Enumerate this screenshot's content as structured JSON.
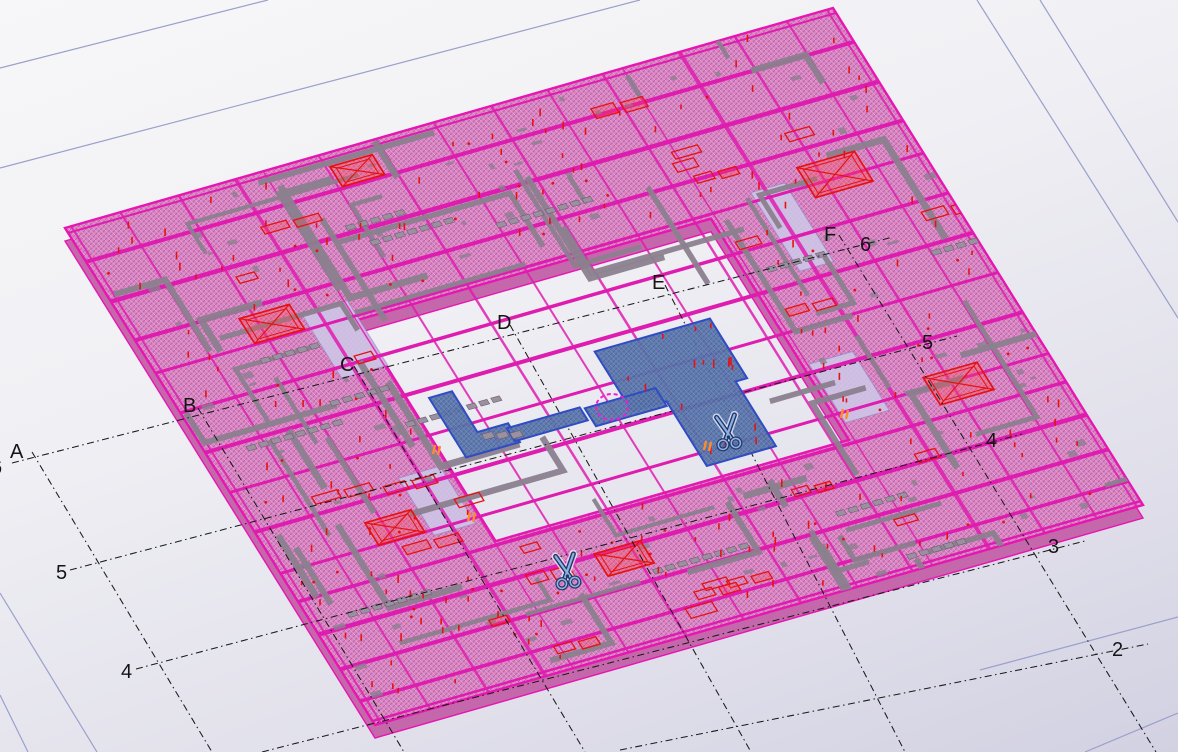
{
  "viewport": {
    "name": "cad-3d-model-view",
    "width": 1178,
    "height": 752
  },
  "grid": {
    "labels": [
      {
        "id": "A",
        "text": "A",
        "x": 10,
        "y": 458
      },
      {
        "id": "B",
        "text": "B",
        "x": 183,
        "y": 412
      },
      {
        "id": "C",
        "text": "C",
        "x": 340,
        "y": 371
      },
      {
        "id": "D",
        "text": "D",
        "x": 497,
        "y": 329
      },
      {
        "id": "E",
        "text": "E",
        "x": 652,
        "y": 289
      },
      {
        "id": "F",
        "text": "F",
        "x": 824,
        "y": 241
      },
      {
        "id": "6-left",
        "text": "6",
        "x": -9,
        "y": 474
      },
      {
        "id": "5-left",
        "text": "5",
        "x": 56,
        "y": 579
      },
      {
        "id": "4-left",
        "text": "4",
        "x": 121,
        "y": 678
      },
      {
        "id": "6-right",
        "text": "6",
        "x": 860,
        "y": 251
      },
      {
        "id": "5-right",
        "text": "5",
        "x": 922,
        "y": 349
      },
      {
        "id": "4-right",
        "text": "4",
        "x": 986,
        "y": 447
      },
      {
        "id": "3-right",
        "text": "3",
        "x": 1048,
        "y": 553
      },
      {
        "id": "2-right",
        "text": "2",
        "x": 1112,
        "y": 656
      }
    ],
    "lines": [
      {
        "id": "A",
        "x1": 32,
        "y1": 452,
        "x2": 212,
        "y2": 752
      },
      {
        "id": "B",
        "x1": 198,
        "y1": 408,
        "x2": 404,
        "y2": 752
      },
      {
        "id": "C",
        "x1": 354,
        "y1": 366,
        "x2": 585,
        "y2": 752
      },
      {
        "id": "D",
        "x1": 510,
        "y1": 325,
        "x2": 751,
        "y2": 752
      },
      {
        "id": "E",
        "x1": 665,
        "y1": 285,
        "x2": 905,
        "y2": 752
      },
      {
        "id": "F",
        "x1": 839,
        "y1": 235,
        "x2": 1156,
        "y2": 752
      },
      {
        "id": "6",
        "x1": 12,
        "y1": 463,
        "x2": 893,
        "y2": 237
      },
      {
        "id": "5",
        "x1": 70,
        "y1": 570,
        "x2": 957,
        "y2": 336
      },
      {
        "id": "4",
        "x1": 136,
        "y1": 669,
        "x2": 1022,
        "y2": 434
      },
      {
        "id": "3",
        "x1": 262,
        "y1": 752,
        "x2": 1085,
        "y2": 541
      },
      {
        "id": "2",
        "x1": 620,
        "y1": 750,
        "x2": 1148,
        "y2": 644
      }
    ]
  },
  "boundary_lines": [
    {
      "x1": 0,
      "y1": 68,
      "x2": 268,
      "y2": 0
    },
    {
      "x1": 0,
      "y1": 168,
      "x2": 640,
      "y2": 0
    },
    {
      "x1": 977,
      "y1": 0,
      "x2": 1178,
      "y2": 318
    },
    {
      "x1": 1040,
      "y1": 0,
      "x2": 1178,
      "y2": 222
    },
    {
      "x1": 0,
      "y1": 593,
      "x2": 97,
      "y2": 752
    },
    {
      "x1": 0,
      "y1": 695,
      "x2": 28,
      "y2": 752
    },
    {
      "x1": 980,
      "y1": 670,
      "x2": 1178,
      "y2": 617
    },
    {
      "x1": 1085,
      "y1": 752,
      "x2": 1178,
      "y2": 713
    }
  ],
  "scene": {
    "plan_transform": {
      "a": 0.768,
      "b": -0.22,
      "c": 0.31,
      "d": 0.497,
      "e": 65,
      "f": 228
    },
    "ring": {
      "outer": [
        [
          0,
          0
        ],
        [
          1000,
          0
        ],
        [
          1000,
          1000
        ],
        [
          0,
          1000
        ]
      ],
      "hole": [
        [
          260,
          300
        ],
        [
          720,
          300
        ],
        [
          720,
          745
        ],
        [
          260,
          745
        ]
      ],
      "thickness_px": 13
    },
    "panels": [
      {
        "x": 782,
        "y": 275,
        "w": 44,
        "h": 158
      },
      {
        "x": 728,
        "y": 596,
        "w": 57,
        "h": 118
      },
      {
        "x": 202,
        "y": 262,
        "w": 60,
        "h": 130
      },
      {
        "x": 196,
        "y": 590,
        "w": 54,
        "h": 115
      }
    ],
    "beams_x": [
      {
        "y": 10,
        "w": 2
      },
      {
        "y": 68,
        "w": 4
      },
      {
        "y": 148,
        "w": 4.5
      },
      {
        "y": 226,
        "w": 4
      },
      {
        "y": 292,
        "w": 3
      },
      {
        "y": 372,
        "w": 3.5
      },
      {
        "y": 452,
        "w": 4
      },
      {
        "y": 532,
        "w": 3
      },
      {
        "y": 612,
        "w": 4
      },
      {
        "y": 695,
        "w": 3
      },
      {
        "y": 752,
        "w": 3.5
      },
      {
        "y": 818,
        "w": 4.5
      },
      {
        "y": 888,
        "w": 4
      },
      {
        "y": 952,
        "w": 3.5
      },
      {
        "y": 992,
        "w": 2.5
      }
    ],
    "beams_y": [
      {
        "x": 8,
        "w": 2
      },
      {
        "x": 72,
        "w": 2
      },
      {
        "x": 148,
        "w": 2.5
      },
      {
        "x": 222,
        "w": 3.5
      },
      {
        "x": 258,
        "w": 1.5
      },
      {
        "x": 330,
        "w": 2
      },
      {
        "x": 405,
        "w": 2.5
      },
      {
        "x": 480,
        "w": 2
      },
      {
        "x": 555,
        "w": 2.5
      },
      {
        "x": 628,
        "w": 2
      },
      {
        "x": 700,
        "w": 2.5
      },
      {
        "x": 726,
        "w": 1.5
      },
      {
        "x": 800,
        "w": 4
      },
      {
        "x": 872,
        "w": 2.5
      },
      {
        "x": 940,
        "w": 2
      },
      {
        "x": 992,
        "w": 2
      }
    ],
    "components": [
      {
        "x": 850,
        "y": 255,
        "w": 75,
        "h": 60,
        "cross": true
      },
      {
        "x": 845,
        "y": 675,
        "w": 70,
        "h": 55,
        "cross": true
      },
      {
        "x": 130,
        "y": 240,
        "w": 65,
        "h": 50,
        "cross": true
      },
      {
        "x": 128,
        "y": 650,
        "w": 60,
        "h": 45,
        "cross": true
      },
      {
        "x": 360,
        "y": 815,
        "w": 60,
        "h": 45,
        "cross": true
      },
      {
        "x": 335,
        "y": 25,
        "w": 55,
        "h": 40,
        "cross": true
      }
    ],
    "blue_parts": {
      "main_slab_path": [
        [
          500,
          470
        ],
        [
          650,
          470
        ],
        [
          650,
          590
        ],
        [
          635,
          590
        ],
        [
          635,
          720
        ],
        [
          545,
          720
        ],
        [
          545,
          590
        ],
        [
          500,
          590
        ]
      ],
      "l_piece_path": [
        [
          285,
          468
        ],
        [
          315,
          468
        ],
        [
          315,
          550
        ],
        [
          355,
          550
        ],
        [
          355,
          588
        ],
        [
          285,
          588
        ]
      ],
      "bar": [
        [
          350,
          558
        ],
        [
          445,
          558
        ],
        [
          445,
          584
        ],
        [
          350,
          584
        ]
      ],
      "circle_piece": [
        [
          450,
          562
        ],
        [
          542,
          562
        ],
        [
          542,
          598
        ],
        [
          450,
          598
        ]
      ]
    },
    "scissors": [
      {
        "x": 728,
        "y": 434
      },
      {
        "x": 567,
        "y": 573
      }
    ],
    "selection_circle": {
      "x": 612,
      "y": 407,
      "rx": 16,
      "ry": 13
    },
    "orange_marks": [
      [
        706,
        441
      ],
      [
        435,
        445
      ],
      [
        843,
        409
      ],
      [
        470,
        512
      ]
    ],
    "random": {
      "seed": 7,
      "gray_beams": 58,
      "stud_rows": 13,
      "gray_bits": 85,
      "red_ticks": 175,
      "red_dots": 55,
      "red_boxes": 26
    }
  },
  "colors": {
    "boundary": "#9aa0cb",
    "grid_line": "#1a1a1a",
    "slab_base": "#d887c3",
    "slab_hatch_dark": "#bf63a8",
    "slab_hatch_light": "#e8a6d6",
    "slab_side": "#c468ab",
    "edge_magenta": "#e715b2",
    "beam_magenta": "#df1cb0",
    "gray_beam": "#8b7f8e",
    "gray_dark": "#6b5f70",
    "stud": "#9b90a0",
    "red": "#e51212",
    "panel": "#cec9e9",
    "panel_edge": "#8c82be",
    "blue_base": "#5b76aa",
    "blue_hatch": "#49619b",
    "blue_hatch_light": "#6d89c0",
    "blue_edge": "#2f4cc2",
    "scissors_dark": "#1f3668",
    "scissors_light": "#8fb0e0",
    "scissors_halo": "#edf1fb",
    "circle_magenta": "#f21ad8",
    "orange": "#ff8c2a"
  },
  "icons": [
    {
      "name": "scissors-cut-icon",
      "meaning": "cut symbol"
    },
    {
      "name": "selection-circle",
      "meaning": "highlighted connection"
    }
  ]
}
